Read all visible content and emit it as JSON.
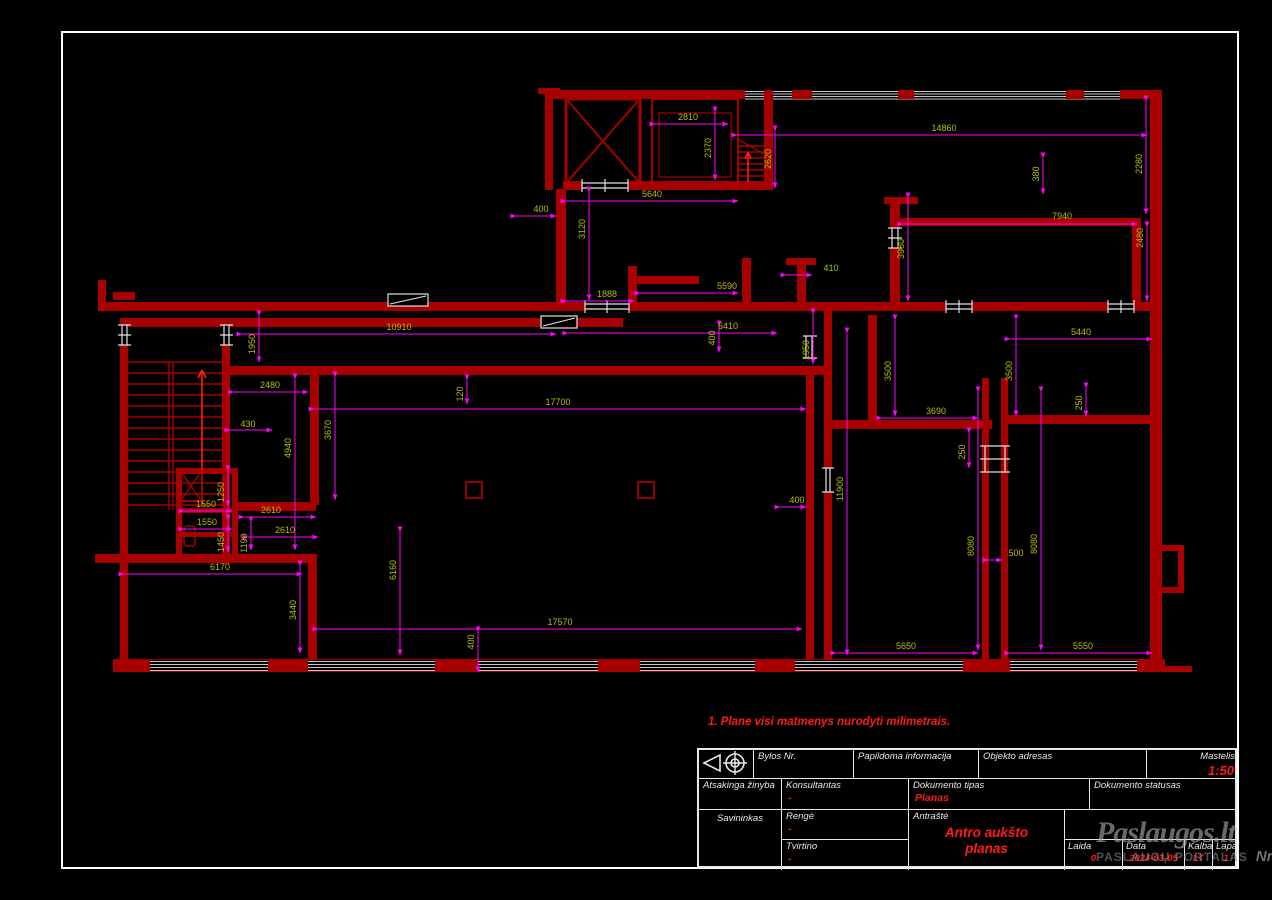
{
  "note": "1. Plane visi matmenys nurodyti milimetrais.",
  "colors": {
    "wall_red": "#a60000",
    "bright_red": "#ff1a1a",
    "dimension_line": "#ff00ff",
    "dimension_text": "#bcbc00",
    "frame_white": "#e8e8e8",
    "window_gray": "#c7c7c7"
  },
  "title_block": {
    "bylos_label": "Bylos Nr.",
    "papildoma_label": "Papildoma informacija",
    "objekto_label": "Objekto adresas",
    "mastelis_label": "Mastelis",
    "mastelis_value": "1:50",
    "atsakinga_label": "Atsakinga žinyba",
    "konsultantas_label": "Konsultantas",
    "konsultantas_value": "-",
    "dok_tipas_label": "Dokumento tipas",
    "dok_tipas_value": "Planas",
    "dok_statusas_label": "Dokumento statusas",
    "savininkas_label": "Savininkas",
    "renge_label": "Rengė",
    "renge_value": "-",
    "tvirtino_label": "Tvirtino",
    "tvirtino_value": "-",
    "antraste_label": "Antraštė",
    "antraste_value": "Antro aukšto planas",
    "laida_label": "Laida",
    "laida_value": "0",
    "data_label": "Data",
    "data_value": "2024-03-05",
    "kalba_label": "Kalba",
    "kalba_value": "LT",
    "lapas_label": "Lapas",
    "lapas_value": "1"
  },
  "watermark": {
    "brand": "Paslaugos.lt",
    "tagline": "PASLAUGŲ PORTALAS",
    "badge": "Nr.1"
  },
  "drawing": {
    "dimensions": [
      {
        "t": "2810",
        "x": 688,
        "y": 120,
        "r": 0
      },
      {
        "t": "5640",
        "x": 652,
        "y": 197,
        "r": 0
      },
      {
        "t": "400",
        "x": 541,
        "y": 212,
        "r": 0
      },
      {
        "t": "14860",
        "x": 944,
        "y": 131,
        "r": 0
      },
      {
        "t": "7940",
        "x": 1062,
        "y": 219,
        "r": 0
      },
      {
        "t": "410",
        "x": 831,
        "y": 271,
        "r": 0
      },
      {
        "t": "5590",
        "x": 727,
        "y": 289,
        "r": 0
      },
      {
        "t": "1888",
        "x": 607,
        "y": 297,
        "r": 0
      },
      {
        "t": "6410",
        "x": 728,
        "y": 329,
        "r": 0
      },
      {
        "t": "10910",
        "x": 399,
        "y": 330,
        "r": 0
      },
      {
        "t": "5440",
        "x": 1081,
        "y": 335,
        "r": 0
      },
      {
        "t": "2480",
        "x": 270,
        "y": 388,
        "r": 0
      },
      {
        "t": "17700",
        "x": 558,
        "y": 405,
        "r": 0
      },
      {
        "t": "430",
        "x": 248,
        "y": 427,
        "r": 0
      },
      {
        "t": "3690",
        "x": 936,
        "y": 414,
        "r": 0
      },
      {
        "t": "400",
        "x": 797,
        "y": 503,
        "r": 0
      },
      {
        "t": "1550",
        "x": 206,
        "y": 507,
        "r": 0
      },
      {
        "t": "2610",
        "x": 271,
        "y": 513,
        "r": 0
      },
      {
        "t": "1550",
        "x": 207,
        "y": 525,
        "r": 0
      },
      {
        "t": "2610",
        "x": 285,
        "y": 533,
        "r": 0
      },
      {
        "t": "6170",
        "x": 220,
        "y": 570,
        "r": 0
      },
      {
        "t": "500",
        "x": 1016,
        "y": 556,
        "r": 0
      },
      {
        "t": "17570",
        "x": 560,
        "y": 625,
        "r": 0
      },
      {
        "t": "5650",
        "x": 906,
        "y": 649,
        "r": 0
      },
      {
        "t": "5550",
        "x": 1083,
        "y": 649,
        "r": 0
      },
      {
        "t": "2370",
        "x": 711,
        "y": 148,
        "r": 1
      },
      {
        "t": "2620",
        "x": 771,
        "y": 159,
        "r": 1
      },
      {
        "t": "3120",
        "x": 585,
        "y": 229,
        "r": 1
      },
      {
        "t": "380",
        "x": 1039,
        "y": 174,
        "r": 1
      },
      {
        "t": "2280",
        "x": 1142,
        "y": 164,
        "r": 1
      },
      {
        "t": "2480",
        "x": 1143,
        "y": 238,
        "r": 1
      },
      {
        "t": "3980",
        "x": 904,
        "y": 249,
        "r": 1
      },
      {
        "t": "400",
        "x": 715,
        "y": 338,
        "r": 1
      },
      {
        "t": "1950",
        "x": 809,
        "y": 350,
        "r": 1
      },
      {
        "t": "1950",
        "x": 255,
        "y": 344,
        "r": 1
      },
      {
        "t": "3500",
        "x": 891,
        "y": 371,
        "r": 1
      },
      {
        "t": "3500",
        "x": 1012,
        "y": 371,
        "r": 1
      },
      {
        "t": "120",
        "x": 463,
        "y": 394,
        "r": 1
      },
      {
        "t": "3670",
        "x": 331,
        "y": 430,
        "r": 1
      },
      {
        "t": "4940",
        "x": 291,
        "y": 448,
        "r": 1
      },
      {
        "t": "250",
        "x": 1082,
        "y": 403,
        "r": 1
      },
      {
        "t": "250",
        "x": 965,
        "y": 452,
        "r": 1
      },
      {
        "t": "11900",
        "x": 843,
        "y": 489,
        "r": 1
      },
      {
        "t": "1250",
        "x": 224,
        "y": 492,
        "r": 1
      },
      {
        "t": "1450",
        "x": 224,
        "y": 542,
        "r": 1
      },
      {
        "t": "1190",
        "x": 247,
        "y": 543,
        "r": 1
      },
      {
        "t": "3440",
        "x": 296,
        "y": 610,
        "r": 1
      },
      {
        "t": "6160",
        "x": 396,
        "y": 570,
        "r": 1
      },
      {
        "t": "400",
        "x": 474,
        "y": 642,
        "r": 1
      },
      {
        "t": "8080",
        "x": 974,
        "y": 546,
        "r": 1
      },
      {
        "t": "8080",
        "x": 1037,
        "y": 544,
        "r": 1
      }
    ]
  }
}
